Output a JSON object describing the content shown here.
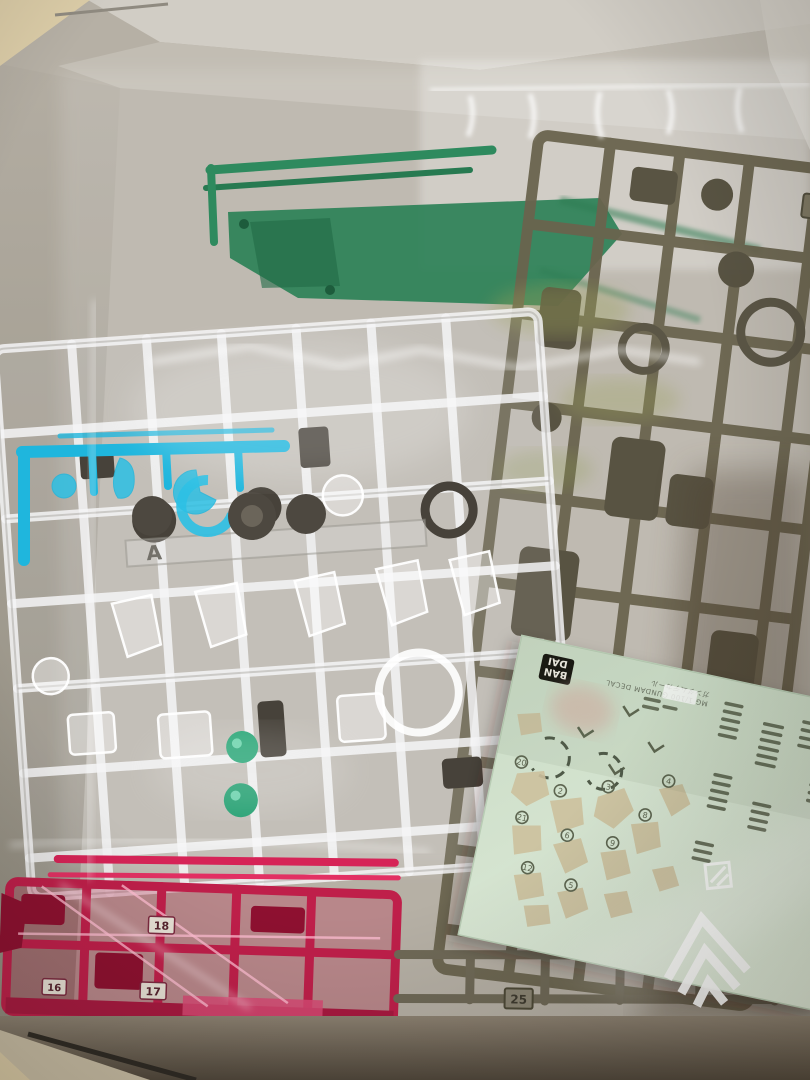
{
  "scene": {
    "alt": "Opened model-kit box containing plastic-bagged runner sprues (clear, clear-blue, clear-red, green and olive) and a pale-green water-slide decal sheet",
    "wall_color": "#dccda8",
    "box_color": "#b6b0a5",
    "shadow_color": "#5f5648"
  },
  "runners": {
    "olive": {
      "tag": "H1",
      "color": "#6a644e"
    },
    "clear": {
      "tag": "A",
      "color": "#eceff1"
    },
    "blue": {
      "color": "#1fb6dd"
    },
    "green": {
      "color": "#2e8a5e"
    },
    "red": {
      "color": "#c2204a",
      "tag_16": "16",
      "tag_17": "17",
      "tag_18": "18"
    },
    "grey": {
      "tag": "25",
      "color": "#7a7463"
    }
  },
  "decal_sheet": {
    "brand_top": "BAN",
    "brand_bottom": "DAI",
    "caption_line1": "MG 1/100 GUNDAM DECAL",
    "caption_line2": "ガンダムデカール",
    "sheet_color": "#d2e3cd",
    "mark_color": "#5d6550",
    "blob_color": "#cdc19e",
    "numbers": [
      "20",
      "2",
      "3",
      "8",
      "21",
      "6",
      "9",
      "4",
      "12",
      "5"
    ]
  }
}
